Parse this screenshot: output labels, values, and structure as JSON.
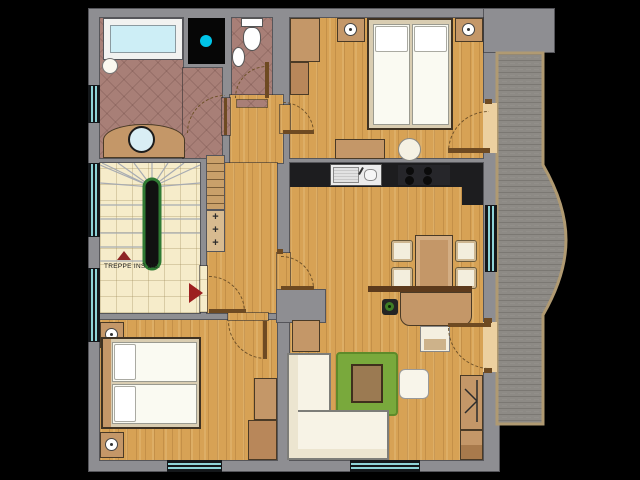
{
  "labels": {
    "stairs_note": "TREPPE INS DG.",
    "plus_mark": "+"
  },
  "palette": {
    "background": "#000000",
    "wall": "#8e8e92",
    "wood_floor": "#d7a255",
    "tile_bath": "#a87f77",
    "tile_stairs": "#f6ecca",
    "deck": "#8d8a85",
    "deck_border": "#b09a72",
    "counter": "#1d1d1f",
    "glass": "#8fd4d8",
    "accent_cyan": "#00c4e8",
    "accent_red": "#9c1f1f",
    "rug_green": "#79a93c",
    "furniture_wood": "#c49768",
    "upholstery": "#f7f3e6"
  },
  "icons": {
    "shaft_vent": "cyan-dot",
    "stairs_up_small": "red-triangle-up",
    "entry_direction": "red-triangle-right",
    "lamp": "ringed-circle",
    "plant": "green-dot-in-pot",
    "cabinet_symbol": "arrow-line"
  }
}
